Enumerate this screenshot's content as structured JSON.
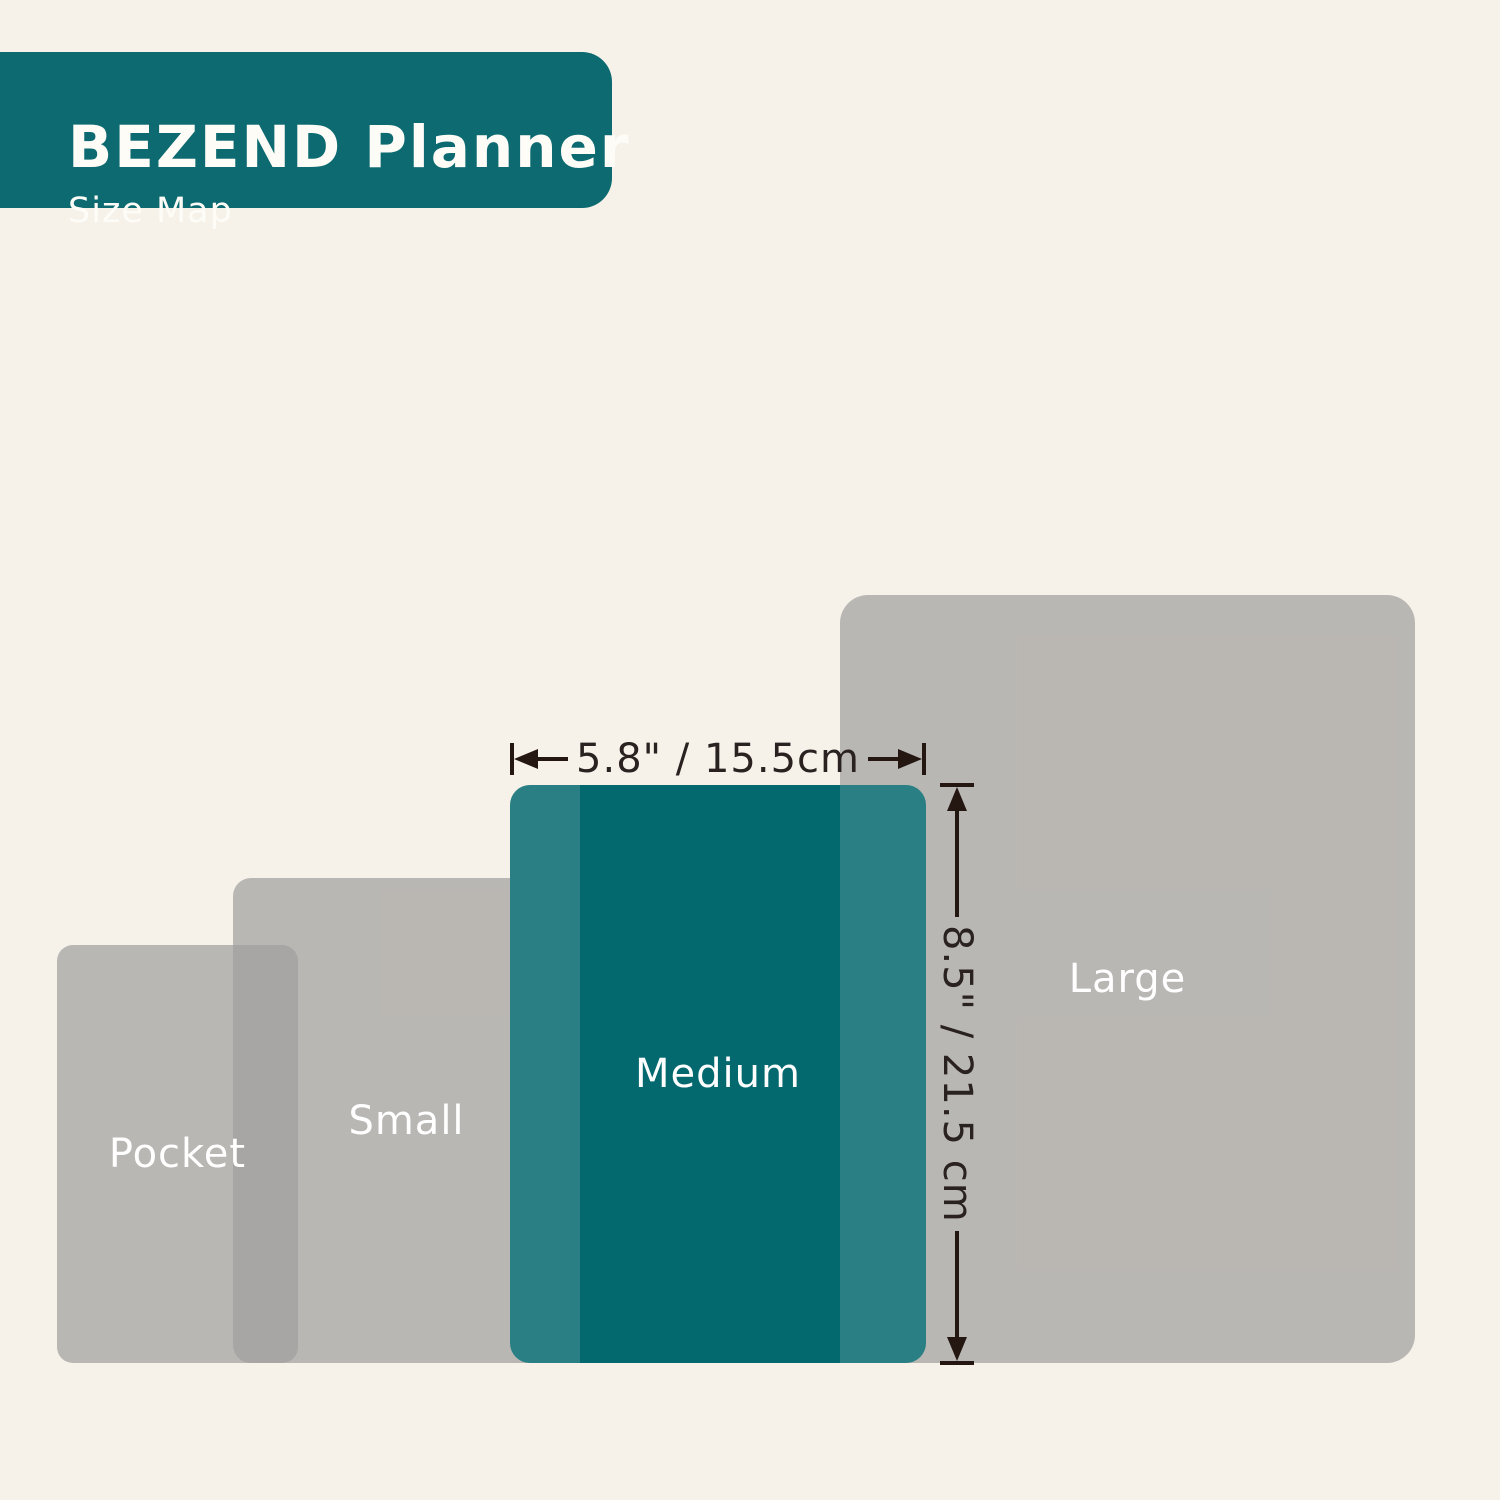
{
  "header": {
    "title": "BEZEND Planner",
    "subtitle": "Size Map"
  },
  "size_map": {
    "sizes": [
      {
        "name": "Pocket",
        "highlighted": false
      },
      {
        "name": "Small",
        "highlighted": false
      },
      {
        "name": "Medium",
        "highlighted": true
      },
      {
        "name": "Large",
        "highlighted": false
      }
    ]
  },
  "dimensions": {
    "width_label": "5.8\" / 15.5cm",
    "height_label": "8.5\" / 21.5 cm"
  },
  "colors": {
    "background": "#F6F2EA",
    "header_teal": "#0C6A70",
    "medium_teal": "#04696E",
    "medium_overlap_teal": "#1F797D",
    "gray_rect": "#B9B7B5",
    "gray_overlap": "#A9A7A6",
    "dimension_line": "#241712",
    "label_text": "#FFFFFF"
  }
}
